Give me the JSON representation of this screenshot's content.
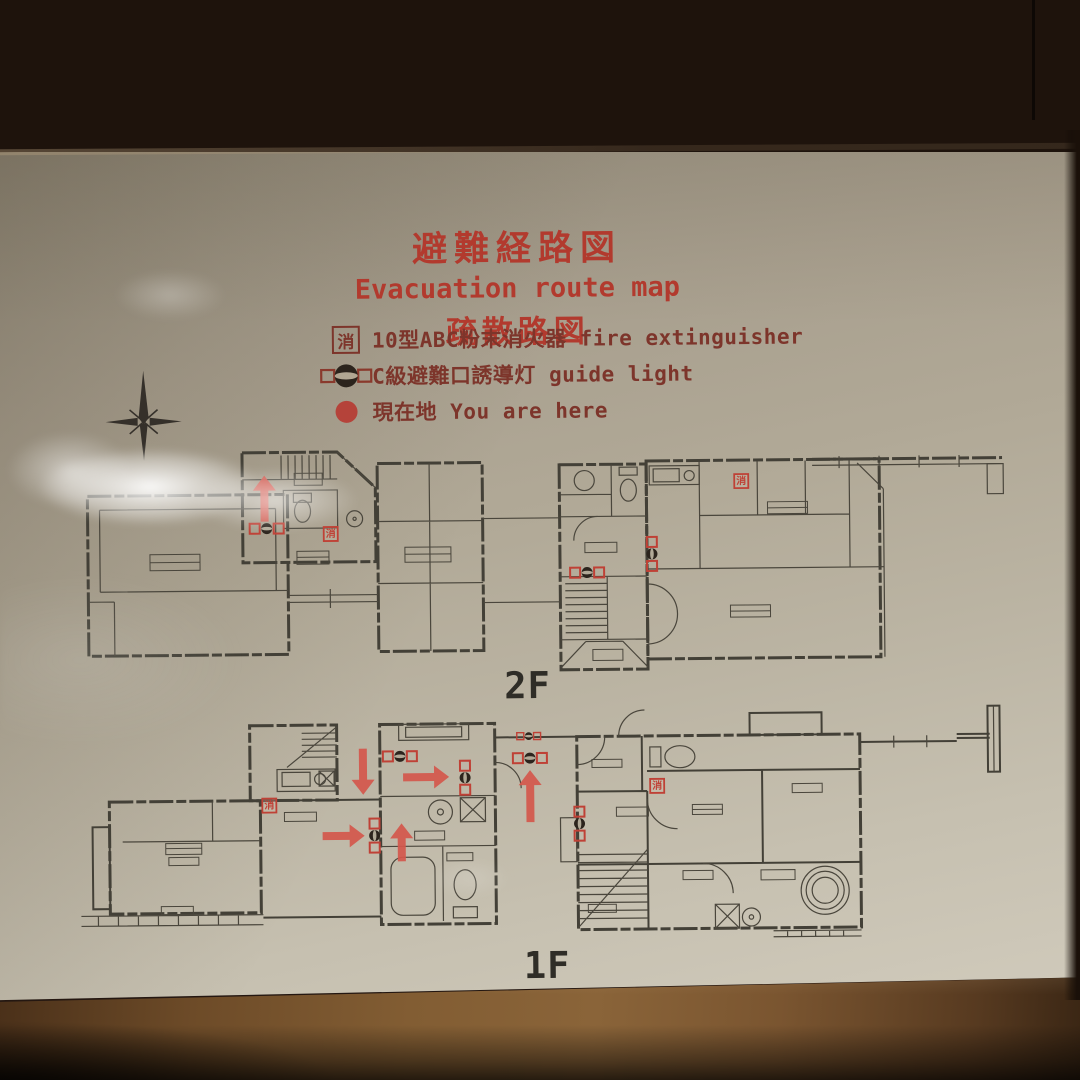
{
  "title": {
    "jp": "避難経路図",
    "en": "Evacuation route map",
    "cn": "疏散路図"
  },
  "legend": {
    "items": [
      {
        "icon": "fire-extinguisher-icon",
        "symbol_char": "消",
        "label": "10型ABC粉末消火器 fire extinguisher"
      },
      {
        "icon": "guide-light-icon",
        "label": "C級避難口誘導灯 guide light"
      },
      {
        "icon": "you-are-here-icon",
        "label": "現在地 You are here"
      }
    ]
  },
  "colors": {
    "title_red": "#b23a2e",
    "legend_text_red": "#7d352b",
    "marker_red": "#bf4136",
    "arrow_red": "#d4574c",
    "plan_line": "#434037",
    "paper_tan": "#b1a997",
    "guide_light_dark": "#2c241d"
  },
  "plans": {
    "ext_char": "消",
    "f2": {
      "label": "2F",
      "arrows": [
        {
          "cx": 265,
          "cy": 496,
          "dir": "up",
          "len": 46
        }
      ],
      "extinguishers": [
        {
          "x": 331,
          "y": 532
        },
        {
          "x": 742,
          "y": 483
        }
      ],
      "guide_lights": [
        {
          "x": 267,
          "y": 526,
          "o": "h"
        },
        {
          "x": 587,
          "y": 573,
          "o": "h"
        },
        {
          "x": 652,
          "y": 555,
          "o": "v"
        }
      ]
    },
    "f1": {
      "label": "1F",
      "arrows": [
        {
          "cx": 361,
          "cy": 770,
          "dir": "down",
          "len": 46
        },
        {
          "cx": 424,
          "cy": 776,
          "dir": "right",
          "len": 46
        },
        {
          "cx": 341,
          "cy": 834,
          "dir": "right",
          "len": 42
        },
        {
          "cx": 399,
          "cy": 841,
          "dir": "up",
          "len": 38
        },
        {
          "cx": 528,
          "cy": 796,
          "dir": "up",
          "len": 52
        }
      ],
      "extinguishers": [
        {
          "x": 267,
          "y": 803
        },
        {
          "x": 655,
          "y": 787
        }
      ],
      "guide_lights": [
        {
          "x": 398,
          "y": 755,
          "o": "h"
        },
        {
          "x": 463,
          "y": 777,
          "o": "v"
        },
        {
          "x": 372,
          "y": 834,
          "o": "v"
        },
        {
          "x": 528,
          "y": 758,
          "o": "h"
        },
        {
          "x": 577,
          "y": 824,
          "o": "v"
        },
        {
          "x": 527,
          "y": 736,
          "o": "h",
          "small": true
        }
      ]
    }
  }
}
